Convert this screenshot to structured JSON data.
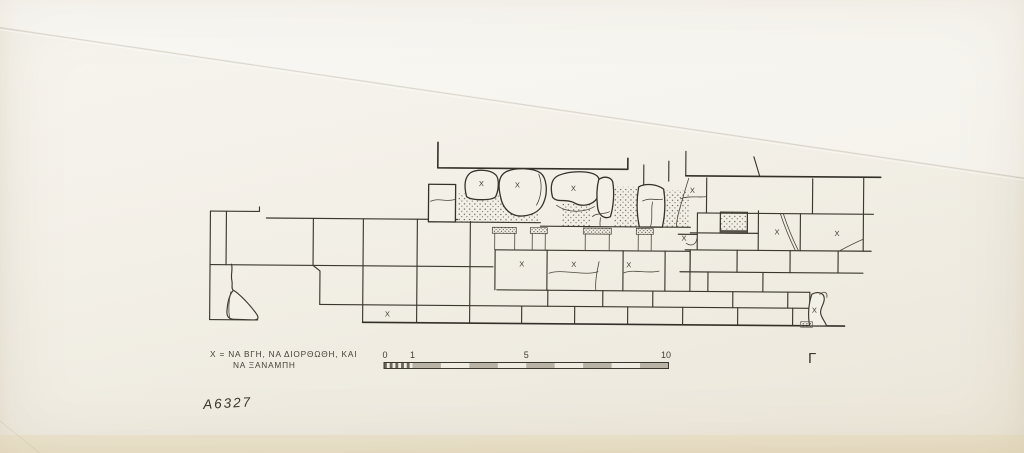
{
  "document": {
    "catalog_number": "A6327",
    "corner_mark": "Γ",
    "legend": {
      "line1": "Χ = ΝΑ ΒΓΗ, ΝΑ ΔΙΟΡΘΩΘΗ, ΚΑΙ",
      "line2": "ΝΑ ΞΑΝΑΜΠΗ"
    }
  },
  "scale_bar": {
    "labels": [
      "0",
      "1",
      "5",
      "10"
    ],
    "unit_count": 10,
    "minor_divisions": 10,
    "x0": 384,
    "x10": 668.5,
    "y": 362.5,
    "height": 6,
    "fill_color": "#b9b3a5",
    "minor_fill_color": "#6b675c"
  },
  "drawing": {
    "x_mark_label": "X",
    "x_marks": [
      {
        "x": 481,
        "y": 184
      },
      {
        "x": 517,
        "y": 185
      },
      {
        "x": 573,
        "y": 188
      },
      {
        "x": 692,
        "y": 189
      },
      {
        "x": 777,
        "y": 230
      },
      {
        "x": 837,
        "y": 231
      },
      {
        "x": 684,
        "y": 237
      },
      {
        "x": 522,
        "y": 264
      },
      {
        "x": 574,
        "y": 264
      },
      {
        "x": 629,
        "y": 264
      },
      {
        "x": 388,
        "y": 315
      },
      {
        "x": 815,
        "y": 308
      }
    ]
  },
  "colors": {
    "ink": "#3b3830",
    "paper": "#f3f0e8",
    "stipple": "#57544b"
  }
}
